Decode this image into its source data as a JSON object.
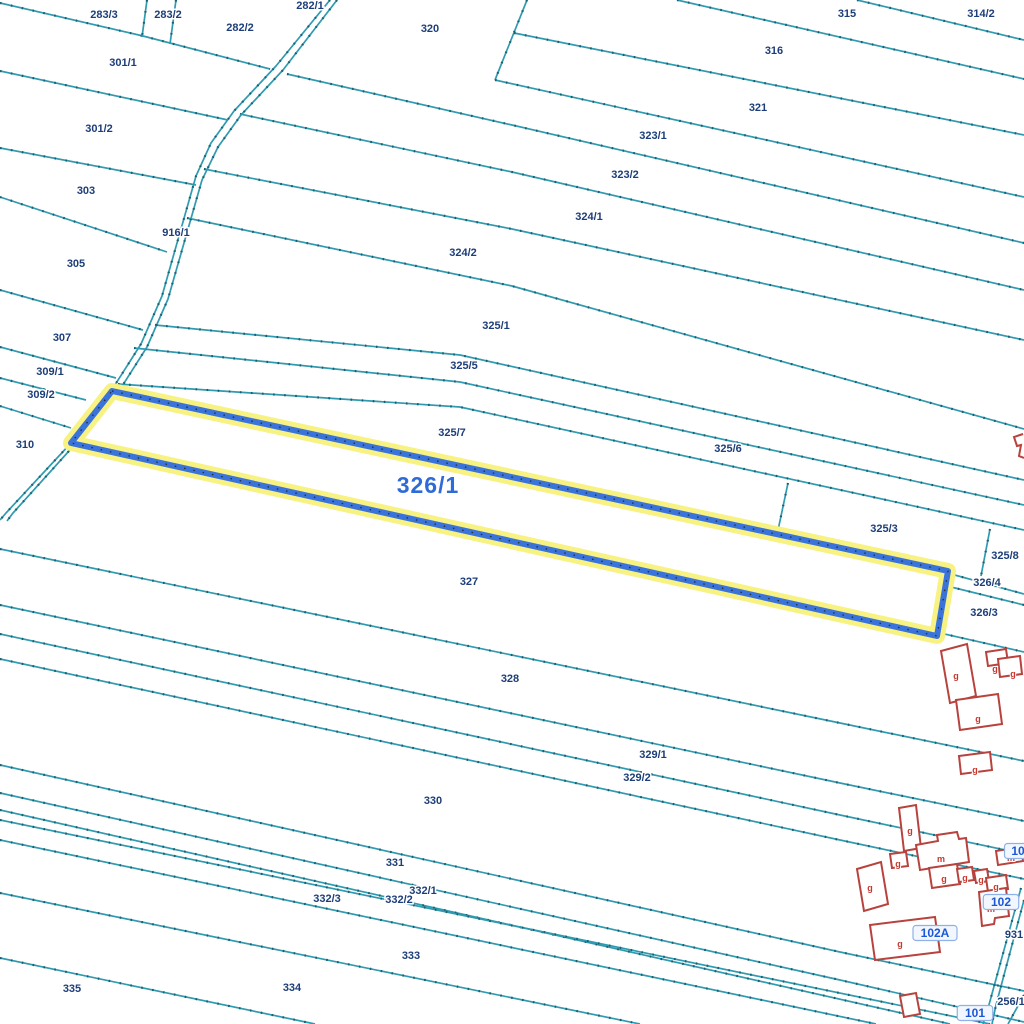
{
  "map": {
    "colors": {
      "background": "#ffffff",
      "boundary": "#2f9ab0",
      "boundary_tick": "#1a5f6e",
      "road_line": "#2f9ab0",
      "parcel_label": "#1d3e79",
      "highlight_stroke": "#3a74da",
      "highlight_halo": "#f8f283",
      "highlight_dots": "#2a2a2a",
      "building_outline": "#b8423d",
      "building_fill": "#ffffff",
      "building_letter": "#c8372e",
      "big_label": "#2f6bd8",
      "badge_text": "#1a58d8",
      "badge_bg": "#f2f7ff",
      "badge_border": "#8fb0e8"
    },
    "boundary_lines": [
      [
        [
          0,
          3
        ],
        [
          143,
          36
        ],
        [
          270,
          69
        ]
      ],
      [
        [
          147,
          0
        ],
        [
          142,
          37
        ]
      ],
      [
        [
          176,
          0
        ],
        [
          170,
          44
        ]
      ],
      [
        [
          0,
          71
        ],
        [
          228,
          120
        ]
      ],
      [
        [
          0,
          148
        ],
        [
          196,
          185
        ]
      ],
      [
        [
          0,
          197
        ],
        [
          167,
          252
        ]
      ],
      [
        [
          0,
          290
        ],
        [
          143,
          330
        ]
      ],
      [
        [
          0,
          347
        ],
        [
          116,
          378
        ]
      ],
      [
        [
          0,
          378
        ],
        [
          86,
          400
        ]
      ],
      [
        [
          0,
          406
        ],
        [
          71,
          428
        ]
      ],
      [
        [
          677,
          0
        ],
        [
          1024,
          79
        ]
      ],
      [
        [
          857,
          0
        ],
        [
          1024,
          40
        ]
      ],
      [
        [
          527,
          0
        ],
        [
          495,
          80
        ]
      ],
      [
        [
          514,
          33
        ],
        [
          1024,
          135
        ]
      ],
      [
        [
          495,
          80
        ],
        [
          1024,
          197
        ]
      ],
      [
        [
          287,
          74
        ],
        [
          512,
          125
        ],
        [
          1024,
          243
        ]
      ],
      [
        [
          240,
          114
        ],
        [
          512,
          172
        ],
        [
          1024,
          290
        ]
      ],
      [
        [
          204,
          169
        ],
        [
          512,
          229
        ],
        [
          1024,
          340
        ]
      ],
      [
        [
          187,
          218
        ],
        [
          512,
          286
        ],
        [
          1024,
          429
        ]
      ],
      [
        [
          155,
          325
        ],
        [
          460,
          355
        ],
        [
          1024,
          480
        ]
      ],
      [
        [
          134,
          348
        ],
        [
          460,
          382
        ],
        [
          1024,
          505
        ]
      ],
      [
        [
          118,
          384
        ],
        [
          460,
          407
        ],
        [
          1024,
          530
        ]
      ],
      [
        [
          788,
          483
        ],
        [
          777,
          535
        ]
      ],
      [
        [
          990,
          529
        ],
        [
          981,
          576
        ]
      ],
      [
        [
          951,
          574
        ],
        [
          1024,
          594
        ]
      ],
      [
        [
          947,
          586
        ],
        [
          1024,
          605
        ]
      ],
      [
        [
          940,
          633
        ],
        [
          1024,
          652
        ]
      ],
      [
        [
          0,
          549
        ],
        [
          840,
          723
        ],
        [
          1024,
          761
        ]
      ],
      [
        [
          0,
          605
        ],
        [
          840,
          783
        ],
        [
          1024,
          821
        ]
      ],
      [
        [
          0,
          634
        ],
        [
          840,
          815
        ],
        [
          1024,
          854
        ]
      ],
      [
        [
          0,
          659
        ],
        [
          840,
          840
        ],
        [
          1024,
          879
        ]
      ],
      [
        [
          0,
          765
        ],
        [
          840,
          952
        ],
        [
          1024,
          991
        ]
      ],
      [
        [
          0,
          793
        ],
        [
          840,
          980
        ],
        [
          1024,
          1022
        ]
      ],
      [
        [
          0,
          810
        ],
        [
          950,
          1024
        ]
      ],
      [
        [
          0,
          820
        ],
        [
          990,
          1024
        ]
      ],
      [
        [
          0,
          840
        ],
        [
          876,
          1024
        ]
      ],
      [
        [
          0,
          893
        ],
        [
          640,
          1024
        ]
      ],
      [
        [
          0,
          958
        ],
        [
          315,
          1024
        ]
      ],
      [
        [
          1021,
          888
        ],
        [
          987,
          1012
        ],
        [
          983,
          1024
        ]
      ],
      [
        [
          1024,
          900
        ],
        [
          996,
          1005
        ],
        [
          992,
          1024
        ]
      ],
      [
        [
          1024,
          995
        ],
        [
          1008,
          1024
        ]
      ]
    ],
    "road": {
      "label": "916/1",
      "lines": [
        [
          [
            330,
            0
          ],
          [
            276,
            66
          ],
          [
            234,
            111
          ],
          [
            211,
            143
          ],
          [
            196,
            176
          ],
          [
            162,
            296
          ],
          [
            141,
            344
          ],
          [
            113,
            388
          ],
          [
            71,
            443
          ],
          [
            6,
            513
          ],
          [
            0,
            520
          ]
        ],
        [
          [
            337,
            0
          ],
          [
            283,
            70
          ],
          [
            241,
            115
          ],
          [
            218,
            147
          ],
          [
            202,
            180
          ],
          [
            168,
            299
          ],
          [
            147,
            347
          ],
          [
            119,
            391
          ],
          [
            78,
            441
          ],
          [
            13,
            513
          ],
          [
            7,
            521
          ]
        ]
      ]
    },
    "highlighted_parcel": {
      "id": "326/1",
      "polygon": [
        [
          112,
          391
        ],
        [
          948,
          571
        ],
        [
          937,
          636
        ],
        [
          71,
          443
        ]
      ],
      "label": {
        "text": "326/1",
        "x": 428,
        "y": 493,
        "size": 23
      }
    },
    "parcel_labels": [
      {
        "t": "283/3",
        "x": 104,
        "y": 18
      },
      {
        "t": "283/2",
        "x": 168,
        "y": 18
      },
      {
        "t": "282/1",
        "x": 310,
        "y": 9
      },
      {
        "t": "282/2",
        "x": 240,
        "y": 31
      },
      {
        "t": "320",
        "x": 430,
        "y": 32
      },
      {
        "t": "315",
        "x": 847,
        "y": 17
      },
      {
        "t": "314/2",
        "x": 981,
        "y": 17
      },
      {
        "t": "316",
        "x": 774,
        "y": 54
      },
      {
        "t": "301/1",
        "x": 123,
        "y": 66
      },
      {
        "t": "321",
        "x": 758,
        "y": 111
      },
      {
        "t": "301/2",
        "x": 99,
        "y": 132
      },
      {
        "t": "323/1",
        "x": 653,
        "y": 139
      },
      {
        "t": "323/2",
        "x": 625,
        "y": 178
      },
      {
        "t": "303",
        "x": 86,
        "y": 194
      },
      {
        "t": "324/1",
        "x": 589,
        "y": 220
      },
      {
        "t": "916/1",
        "x": 176,
        "y": 236
      },
      {
        "t": "324/2",
        "x": 463,
        "y": 256
      },
      {
        "t": "305",
        "x": 76,
        "y": 267
      },
      {
        "t": "325/1",
        "x": 496,
        "y": 329
      },
      {
        "t": "307",
        "x": 62,
        "y": 341
      },
      {
        "t": "325/5",
        "x": 464,
        "y": 369
      },
      {
        "t": "309/1",
        "x": 50,
        "y": 375
      },
      {
        "t": "309/2",
        "x": 41,
        "y": 398
      },
      {
        "t": "325/7",
        "x": 452,
        "y": 436
      },
      {
        "t": "310",
        "x": 25,
        "y": 448
      },
      {
        "t": "325/6",
        "x": 728,
        "y": 452
      },
      {
        "t": "325/3",
        "x": 884,
        "y": 532
      },
      {
        "t": "325/8",
        "x": 1005,
        "y": 559
      },
      {
        "t": "327",
        "x": 469,
        "y": 585
      },
      {
        "t": "326/4",
        "x": 987,
        "y": 586
      },
      {
        "t": "326/3",
        "x": 984,
        "y": 616
      },
      {
        "t": "328",
        "x": 510,
        "y": 682
      },
      {
        "t": "329/1",
        "x": 653,
        "y": 758
      },
      {
        "t": "329/2",
        "x": 637,
        "y": 781
      },
      {
        "t": "330",
        "x": 433,
        "y": 804
      },
      {
        "t": "331",
        "x": 395,
        "y": 866
      },
      {
        "t": "332/1",
        "x": 423,
        "y": 894
      },
      {
        "t": "332/3",
        "x": 327,
        "y": 902
      },
      {
        "t": "332/2",
        "x": 399,
        "y": 903
      },
      {
        "t": "333",
        "x": 411,
        "y": 959
      },
      {
        "t": "335",
        "x": 72,
        "y": 992
      },
      {
        "t": "334",
        "x": 292,
        "y": 991
      },
      {
        "t": "931",
        "x": 1014,
        "y": 938
      },
      {
        "t": "256/1",
        "x": 1011,
        "y": 1005
      }
    ],
    "buildings": {
      "polygons": [
        [
          [
            941,
            651
          ],
          [
            967,
            644
          ],
          [
            976,
            696
          ],
          [
            950,
            703
          ]
        ],
        [
          [
            986,
            652
          ],
          [
            1006,
            649
          ],
          [
            1008,
            663
          ],
          [
            988,
            666
          ]
        ],
        [
          [
            998,
            659
          ],
          [
            1020,
            656
          ],
          [
            1022,
            674
          ],
          [
            1000,
            677
          ]
        ],
        [
          [
            956,
            700
          ],
          [
            998,
            694
          ],
          [
            1002,
            724
          ],
          [
            960,
            730
          ]
        ],
        [
          [
            959,
            756
          ],
          [
            990,
            752
          ],
          [
            992,
            770
          ],
          [
            961,
            774
          ]
        ],
        [
          [
            899,
            808
          ],
          [
            916,
            805
          ],
          [
            921,
            848
          ],
          [
            904,
            851
          ]
        ],
        [
          [
            890,
            854
          ],
          [
            906,
            852
          ],
          [
            908,
            866
          ],
          [
            892,
            868
          ]
        ],
        [
          [
            916,
            845
          ],
          [
            938,
            841
          ],
          [
            937,
            835
          ],
          [
            957,
            832
          ],
          [
            959,
            839
          ],
          [
            966,
            838
          ],
          [
            969,
            862
          ],
          [
            920,
            870
          ]
        ],
        [
          [
            929,
            868
          ],
          [
            957,
            864
          ],
          [
            960,
            884
          ],
          [
            932,
            888
          ]
        ],
        [
          [
            957,
            869
          ],
          [
            972,
            867
          ],
          [
            974,
            880
          ],
          [
            959,
            882
          ]
        ],
        [
          [
            974,
            871
          ],
          [
            987,
            869
          ],
          [
            989,
            881
          ],
          [
            976,
            883
          ]
        ],
        [
          [
            986,
            878
          ],
          [
            1006,
            875
          ],
          [
            1008,
            889
          ],
          [
            988,
            892
          ]
        ],
        [
          [
            979,
            892
          ],
          [
            1006,
            888
          ],
          [
            1009,
            916
          ],
          [
            995,
            918
          ],
          [
            994,
            924
          ],
          [
            982,
            926
          ]
        ],
        [
          [
            857,
            869
          ],
          [
            881,
            862
          ],
          [
            888,
            904
          ],
          [
            864,
            911
          ]
        ],
        [
          [
            870,
            925
          ],
          [
            935,
            917
          ],
          [
            940,
            952
          ],
          [
            875,
            960
          ]
        ],
        [
          [
            996,
            851
          ],
          [
            1021,
            847
          ],
          [
            1023,
            861
          ],
          [
            998,
            865
          ]
        ],
        [
          [
            900,
            996
          ],
          [
            916,
            993
          ],
          [
            920,
            1014
          ],
          [
            904,
            1017
          ]
        ]
      ],
      "open_paths": [
        [
          [
            1023,
            434
          ],
          [
            1014,
            437
          ],
          [
            1017,
            446
          ],
          [
            1021,
            445
          ],
          [
            1019,
            456
          ],
          [
            1024,
            458
          ]
        ]
      ],
      "letters": [
        {
          "t": "g",
          "x": 956,
          "y": 679
        },
        {
          "t": "g",
          "x": 995,
          "y": 672
        },
        {
          "t": "g",
          "x": 1013,
          "y": 677
        },
        {
          "t": "g",
          "x": 978,
          "y": 722
        },
        {
          "t": "g",
          "x": 975,
          "y": 773
        },
        {
          "t": "g",
          "x": 910,
          "y": 834
        },
        {
          "t": "g",
          "x": 898,
          "y": 867
        },
        {
          "t": "m",
          "x": 941,
          "y": 862
        },
        {
          "t": "g",
          "x": 944,
          "y": 882
        },
        {
          "t": "g",
          "x": 965,
          "y": 881
        },
        {
          "t": "g",
          "x": 981,
          "y": 883
        },
        {
          "t": "g",
          "x": 996,
          "y": 890
        },
        {
          "t": "m",
          "x": 991,
          "y": 912
        },
        {
          "t": "g",
          "x": 870,
          "y": 891
        },
        {
          "t": "g",
          "x": 900,
          "y": 947
        },
        {
          "t": "m",
          "x": 1011,
          "y": 861
        }
      ]
    },
    "address_badges": [
      {
        "t": "102A",
        "x": 935,
        "y": 937
      },
      {
        "t": "102",
        "x": 1001,
        "y": 906
      },
      {
        "t": "101",
        "x": 975,
        "y": 1017
      },
      {
        "t": "10",
        "x": 1018,
        "y": 855
      }
    ]
  }
}
